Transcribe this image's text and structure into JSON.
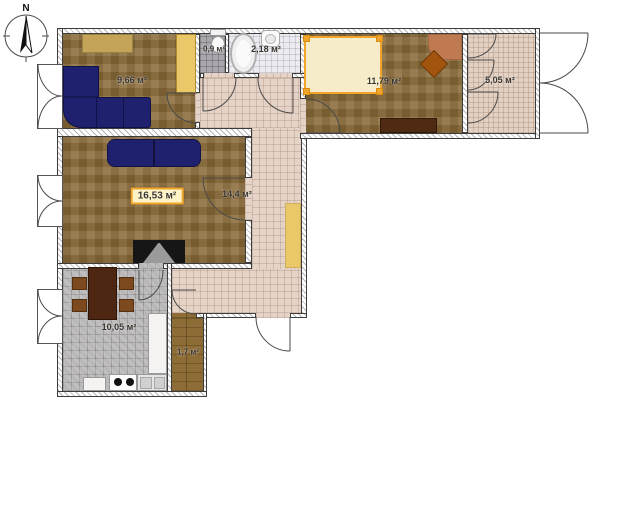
{
  "plan": {
    "title": "apartment-floor-plan",
    "compass": {
      "label": "N"
    },
    "rooms": [
      {
        "name": "lounge",
        "area": "9,66 м²"
      },
      {
        "name": "wc",
        "area": "0,9 м²"
      },
      {
        "name": "bathroom",
        "area": "2,18 м²"
      },
      {
        "name": "bedroom",
        "area": "11,79 м²"
      },
      {
        "name": "balcony",
        "area": "5,05 м²"
      },
      {
        "name": "living-room",
        "area": "16,53 м²",
        "selected": true
      },
      {
        "name": "hallway",
        "area": "14,4 м²"
      },
      {
        "name": "kitchen",
        "area": "10,05 м²"
      },
      {
        "name": "storage",
        "area": "1,7 м²"
      }
    ],
    "colors": {
      "selection_accent": "#f2a52b",
      "selection_fill": "#fdf3c4",
      "carpet": "#8c6e3d",
      "hall_tile": "#e4d3c6",
      "bath_tile": "#ecebef",
      "wc_tile": "#a9a7ac",
      "kitchen_tile": "#b8b6b7",
      "sofa_navy": "#20216e",
      "bed_cream": "#f7ecca",
      "rug_tan": "#c3a458",
      "rug_yellow": "#eac869",
      "desk_terracotta": "#c07a52",
      "wood_dark": "#4e2b12"
    }
  }
}
